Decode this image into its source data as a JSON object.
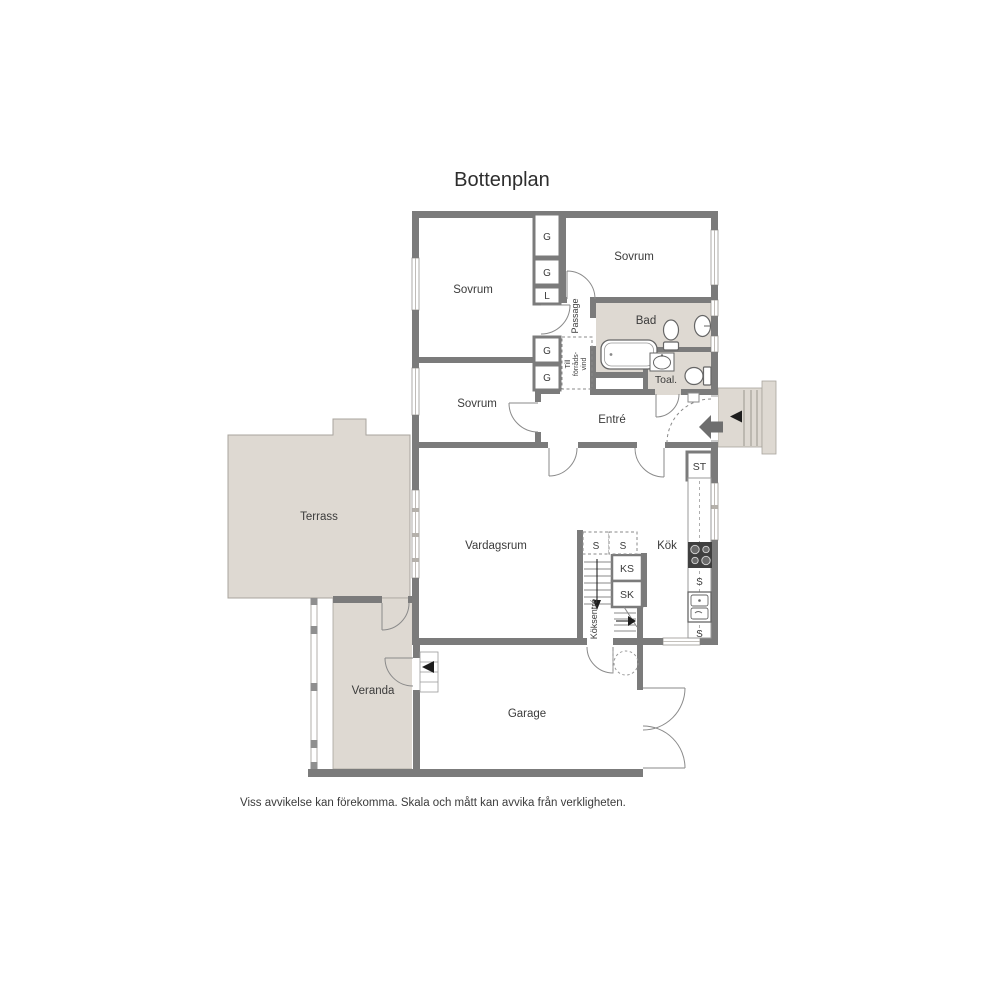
{
  "title": "Bottenplan",
  "disclaimer": "Viss avvikelse kan förekomma. Skala och mått kan avvika från verkligheten.",
  "rooms": {
    "sovrum_top_left": "Sovrum",
    "sovrum_top_right": "Sovrum",
    "sovrum_middle": "Sovrum",
    "bad": "Bad",
    "toal": "Toal.",
    "entre": "Entré",
    "passage": "Passage",
    "vardagsrum": "Vardagsrum",
    "kok": "Kök",
    "garage": "Garage",
    "veranda": "Veranda",
    "terrass": "Terrass"
  },
  "labels": {
    "closet_g_tall": "G",
    "closet_g_upper": "G",
    "closet_l": "L",
    "closet_g_mid_upper": "G",
    "closet_g_mid_lower": "G",
    "closet_st": "ST",
    "stair_s_left": "S",
    "stair_s_right": "S",
    "stair_ks": "KS",
    "stair_sk": "SK",
    "kitchen_s_upper": "S",
    "kitchen_s_lower": "S",
    "koksentre": "Köksentré",
    "attic_line_1": "Till",
    "attic_line_2": "förråds-",
    "attic_line_3": "vind"
  },
  "colors": {
    "wall": "#7b7b7b",
    "floor": "#ffffff",
    "wet_and_outdoor_floor": "#ded9d2",
    "label_text": "#3b3b3b"
  }
}
